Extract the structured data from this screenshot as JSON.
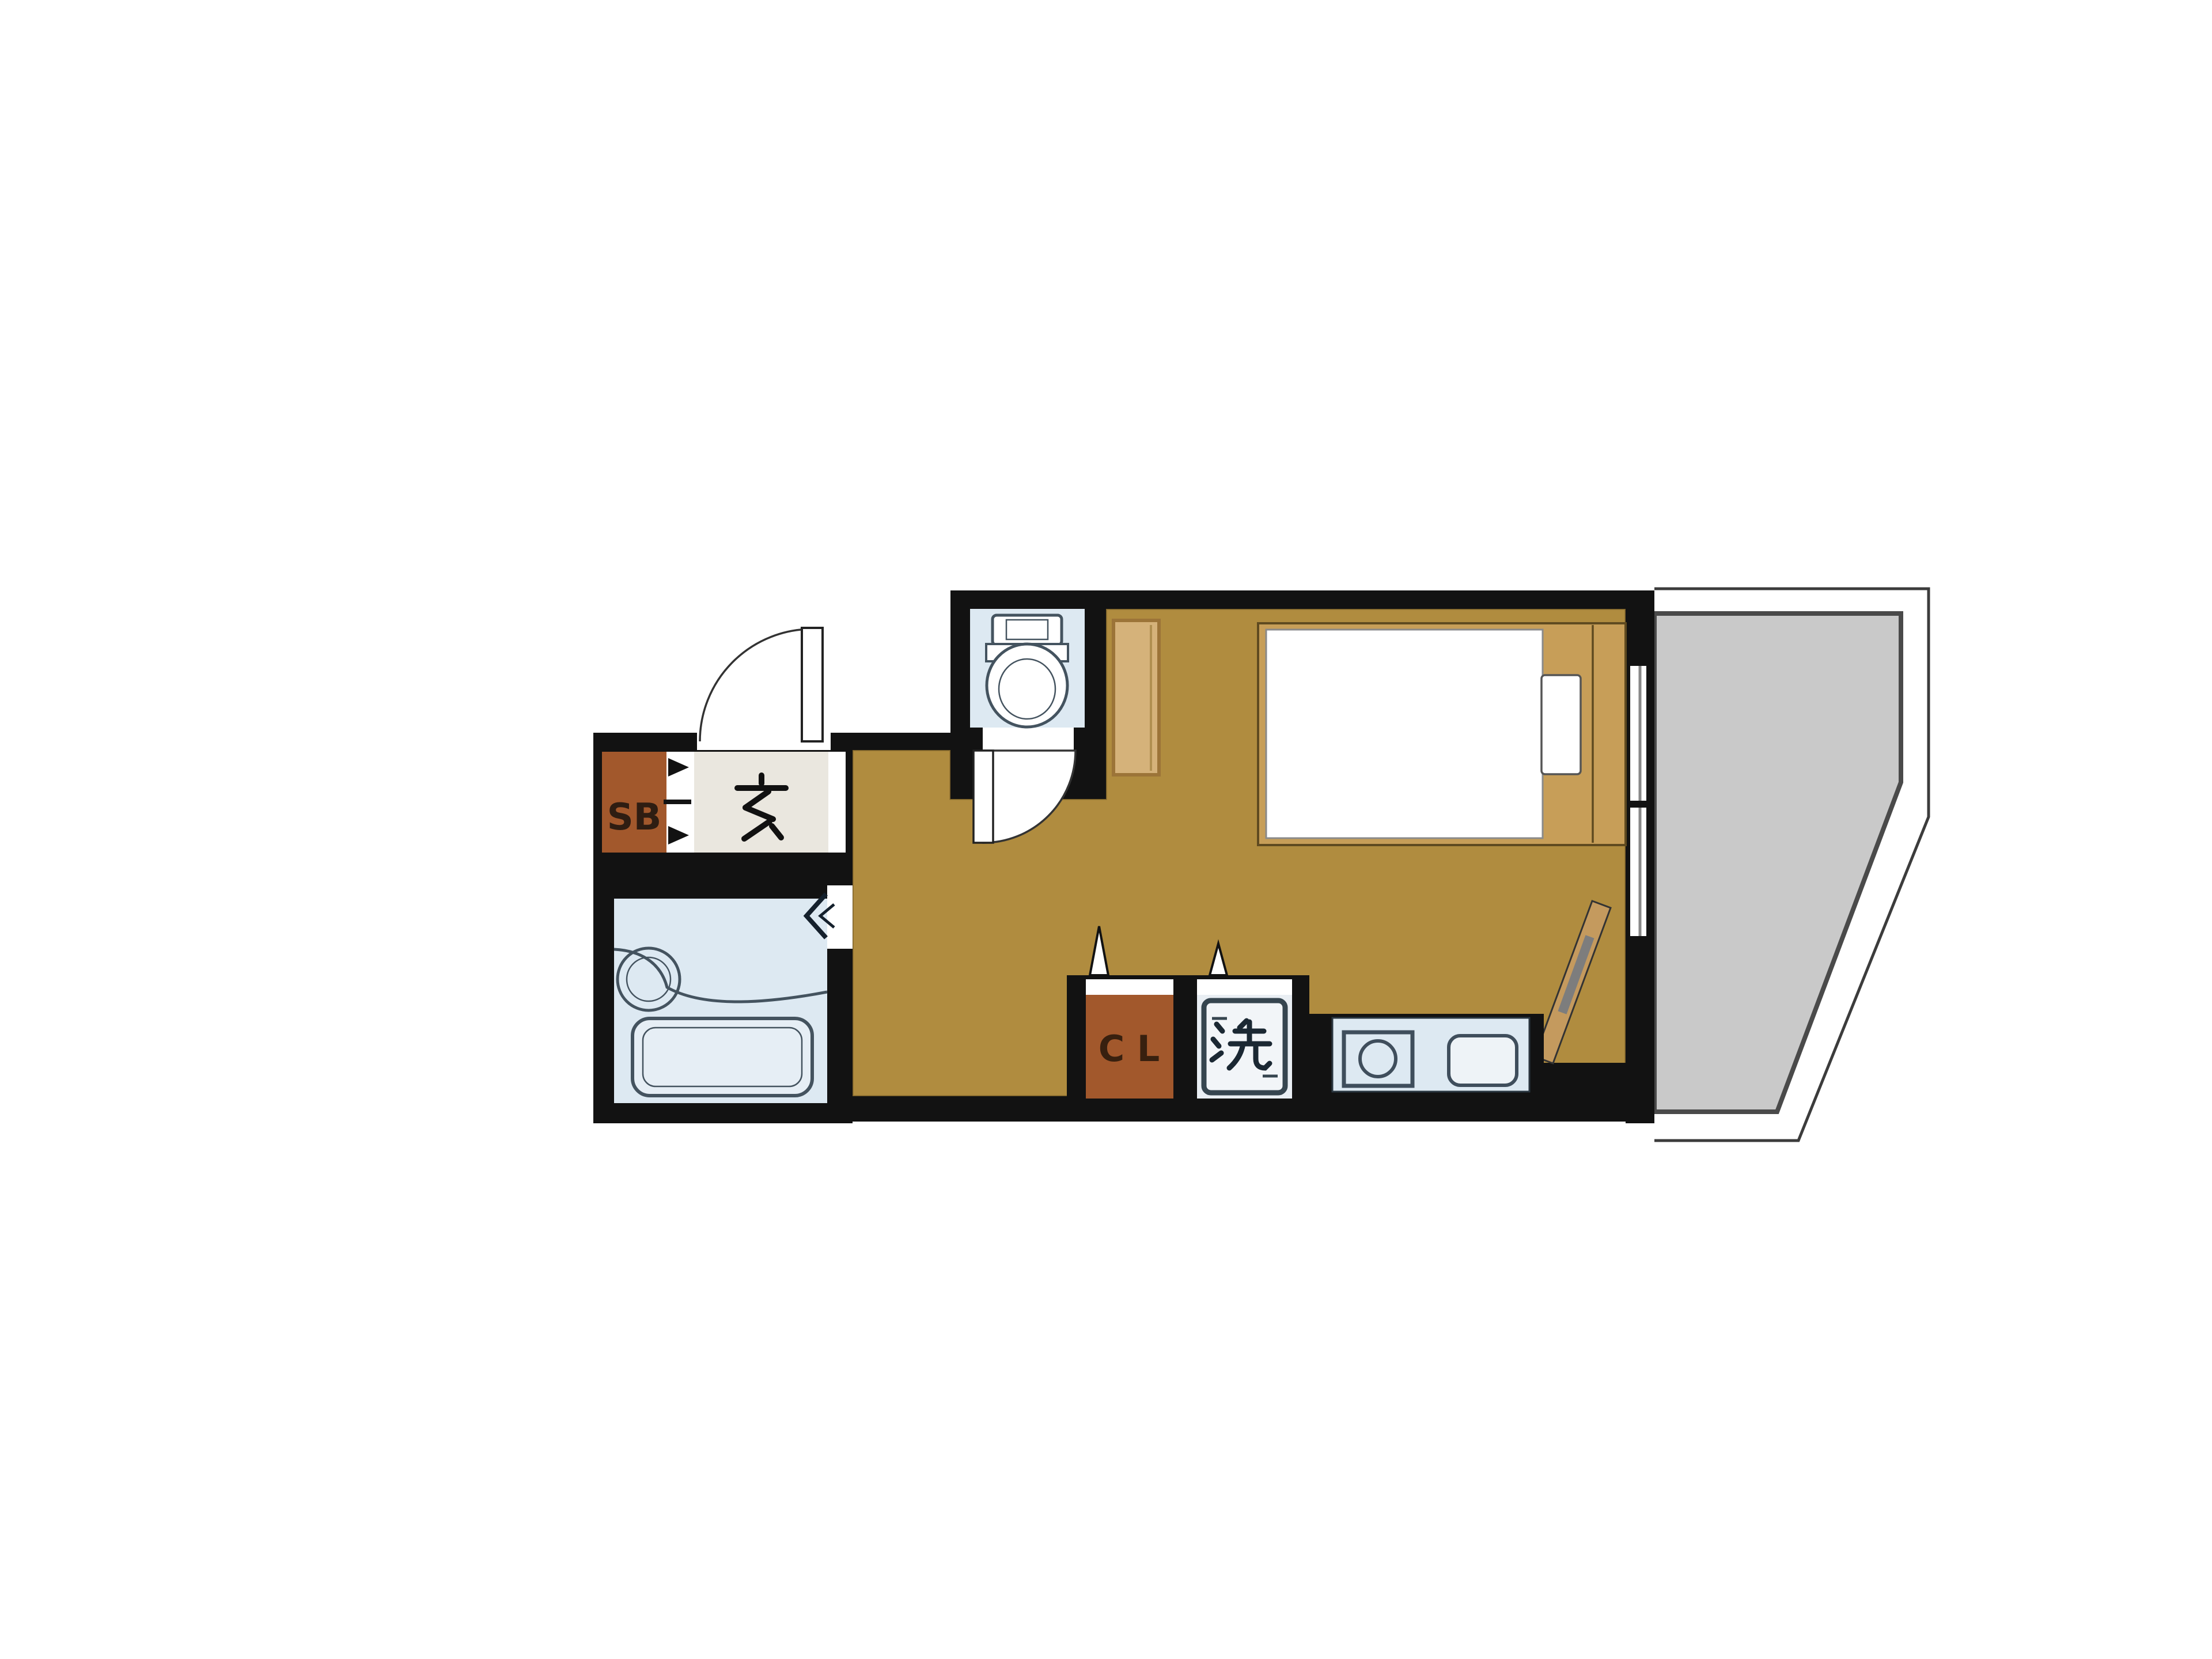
{
  "page": {
    "background_color": "#ffffff"
  },
  "floor_plan": {
    "kind": "japanese-studio-apartment-floor-plan",
    "labels": {
      "shoe_box": "SB",
      "entrance": "玄",
      "closet": "C L",
      "laundry": "洗"
    },
    "colors": {
      "wall": "#121212",
      "flooring": "#b08c3f",
      "wet_area_fill": "#dde9f2",
      "fixture_outline": "#44535f",
      "entrance_floor": "#eae7df",
      "storage_brown": "#a2582c",
      "bed_wood": "#c79e58",
      "cabinet_wood": "#d5b27a",
      "balcony_fill": "#c9c9c9",
      "balcony_border": "#4a4a4a"
    },
    "rooms": [
      {
        "name": "entrance-genkan",
        "label": "玄"
      },
      {
        "name": "shoe-box",
        "label": "SB"
      },
      {
        "name": "unit-bath",
        "label": ""
      },
      {
        "name": "toilet-room",
        "label": ""
      },
      {
        "name": "hallway",
        "label": ""
      },
      {
        "name": "main-room",
        "label": ""
      },
      {
        "name": "closet",
        "label": "C L"
      },
      {
        "name": "laundry-space",
        "label": "洗"
      },
      {
        "name": "kitchen",
        "label": ""
      },
      {
        "name": "balcony",
        "label": ""
      }
    ],
    "fixtures": [
      "entry-door-swing",
      "bathtub",
      "washbasin",
      "toilet-bowl",
      "toilet-door-swing",
      "bed-frame",
      "mattress",
      "pillow",
      "tall-cabinet",
      "leaning-board",
      "closet-sliding-door",
      "laundry-sliding-door",
      "washing-machine",
      "stove-burner",
      "kitchen-sink",
      "balcony-window"
    ]
  }
}
